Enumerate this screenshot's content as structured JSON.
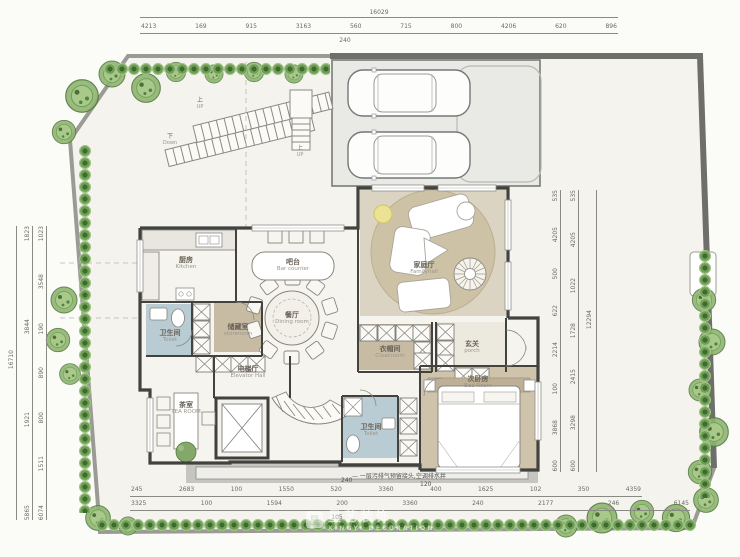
{
  "dims": {
    "top_total": "16029",
    "top_row": [
      "4213",
      "169",
      "915",
      "3163",
      "560",
      "715",
      "800",
      "4206",
      "620",
      "896"
    ],
    "top_sub": "240",
    "left_total": "16710",
    "left_outer": [
      "1823",
      "3844",
      "1921",
      "5865"
    ],
    "left_inner": [
      "1023",
      "3548",
      "190",
      "890",
      "800",
      "1511",
      "6074"
    ],
    "right_total": "12294",
    "right_outer": [
      "535",
      "4205",
      "1022",
      "1728",
      "2415",
      "3298",
      "600"
    ],
    "right_inner": [
      "535",
      "4205",
      "500",
      "622",
      "2214",
      "100",
      "3868",
      "600"
    ],
    "bottom_row1": [
      "245",
      "2683",
      "100",
      "1550",
      "520",
      "3360",
      "400",
      "1625",
      "102",
      "350",
      "4359"
    ],
    "bottom_row2": [
      "3325",
      "100",
      "1594",
      "200",
      "3360",
      "240",
      "2177",
      "246",
      "6145"
    ],
    "bottom_sub": "105"
  },
  "note": {
    "text": "— 一层污排气预留接头,空调排水井",
    "n1": "240",
    "n2": "120"
  },
  "rooms": {
    "family_hall": {
      "cn": "家庭厅",
      "en": "Familyhall"
    },
    "kitchen": {
      "cn": "厨房",
      "en": "Kitchen"
    },
    "bar": {
      "cn": "吧台",
      "en": "Bar counter"
    },
    "dining": {
      "cn": "餐厅",
      "en": "Dining room"
    },
    "toilet_left": {
      "cn": "卫生间",
      "en": "Toilet"
    },
    "storeroom": {
      "cn": "储藏室",
      "en": "storeroom"
    },
    "elevator_hall": {
      "cn": "电梯厅",
      "en": "Elevator Hall"
    },
    "cloakroom": {
      "cn": "衣帽间",
      "en": "Cloakroom"
    },
    "porch": {
      "cn": "玄关",
      "en": "porch"
    },
    "tea_room": {
      "cn": "茶室",
      "en": "TEA ROOM"
    },
    "toilet_bottom": {
      "cn": "卫生间",
      "en": "Toilet"
    },
    "bedroom": {
      "cn": "次卧房",
      "en": "Bed Room"
    }
  },
  "stairs": {
    "down": {
      "cn": "下",
      "en": "Down"
    },
    "up1": {
      "cn": "上",
      "en": "UP"
    },
    "up2": {
      "cn": "上",
      "en": "UP"
    }
  },
  "watermark": {
    "logo": "星",
    "cn": "星艺装饰",
    "en": "XINGYI DECORATION"
  }
}
